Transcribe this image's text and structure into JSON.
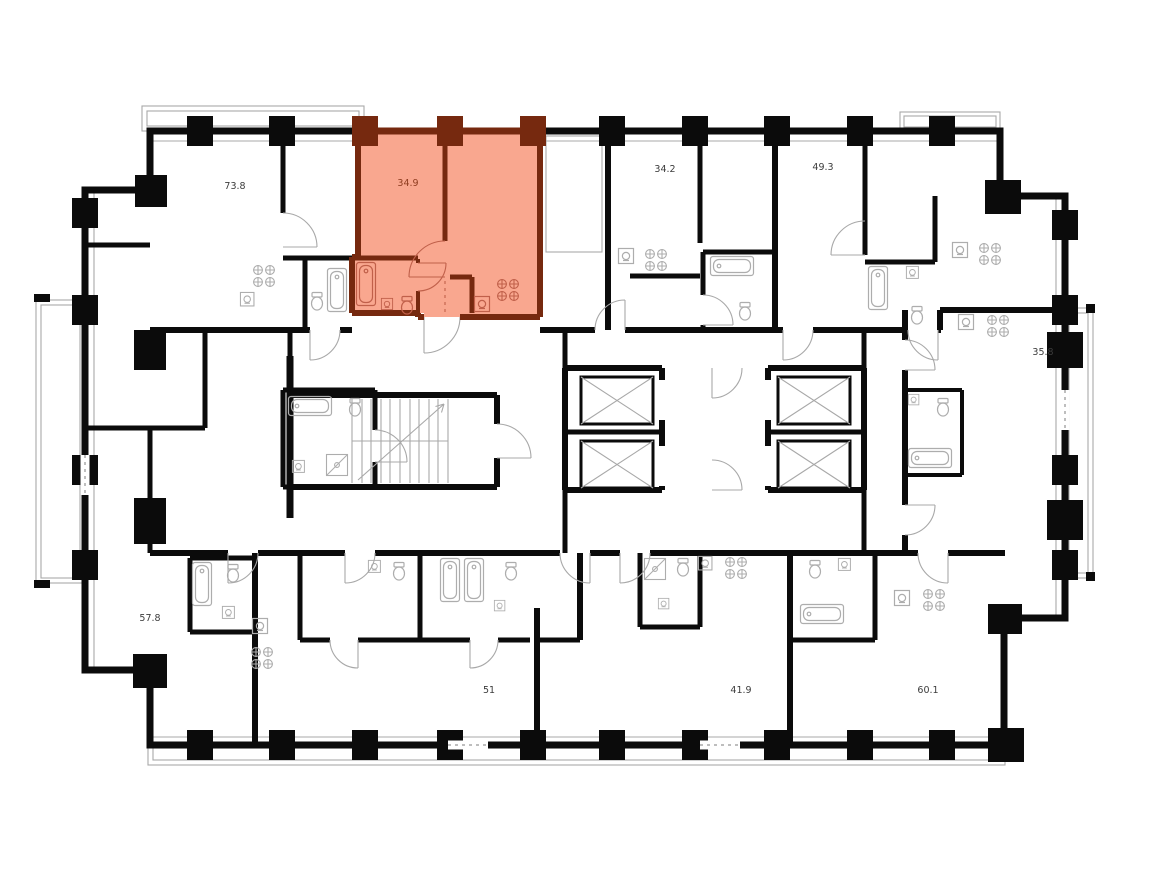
{
  "plan": {
    "title": "residential-floor-plan",
    "units": [
      {
        "name": "unit-73-8",
        "area": "73.8",
        "highlighted": false
      },
      {
        "name": "unit-34-9",
        "area": "34.9",
        "highlighted": true
      },
      {
        "name": "unit-34-2",
        "area": "34.2",
        "highlighted": false
      },
      {
        "name": "unit-49-3",
        "area": "49.3",
        "highlighted": false
      },
      {
        "name": "unit-35-8",
        "area": "35.8",
        "highlighted": false
      },
      {
        "name": "unit-57-8",
        "area": "57.8",
        "highlighted": false
      },
      {
        "name": "unit-51",
        "area": "51",
        "highlighted": false
      },
      {
        "name": "unit-41-9",
        "area": "41.9",
        "highlighted": false
      },
      {
        "name": "unit-60-1",
        "area": "60.1",
        "highlighted": false
      }
    ],
    "highlight": {
      "fill": "#F9A78F",
      "wall": "#76290F",
      "fixture": "#C0604A",
      "label": "#8F3D20"
    },
    "colors": {
      "wall": "#0B0B0B",
      "thin_line": "#A8A8A8",
      "fixture": "#ADADAD",
      "label": "#3C3C3C",
      "background": "#FFFFFF"
    }
  }
}
